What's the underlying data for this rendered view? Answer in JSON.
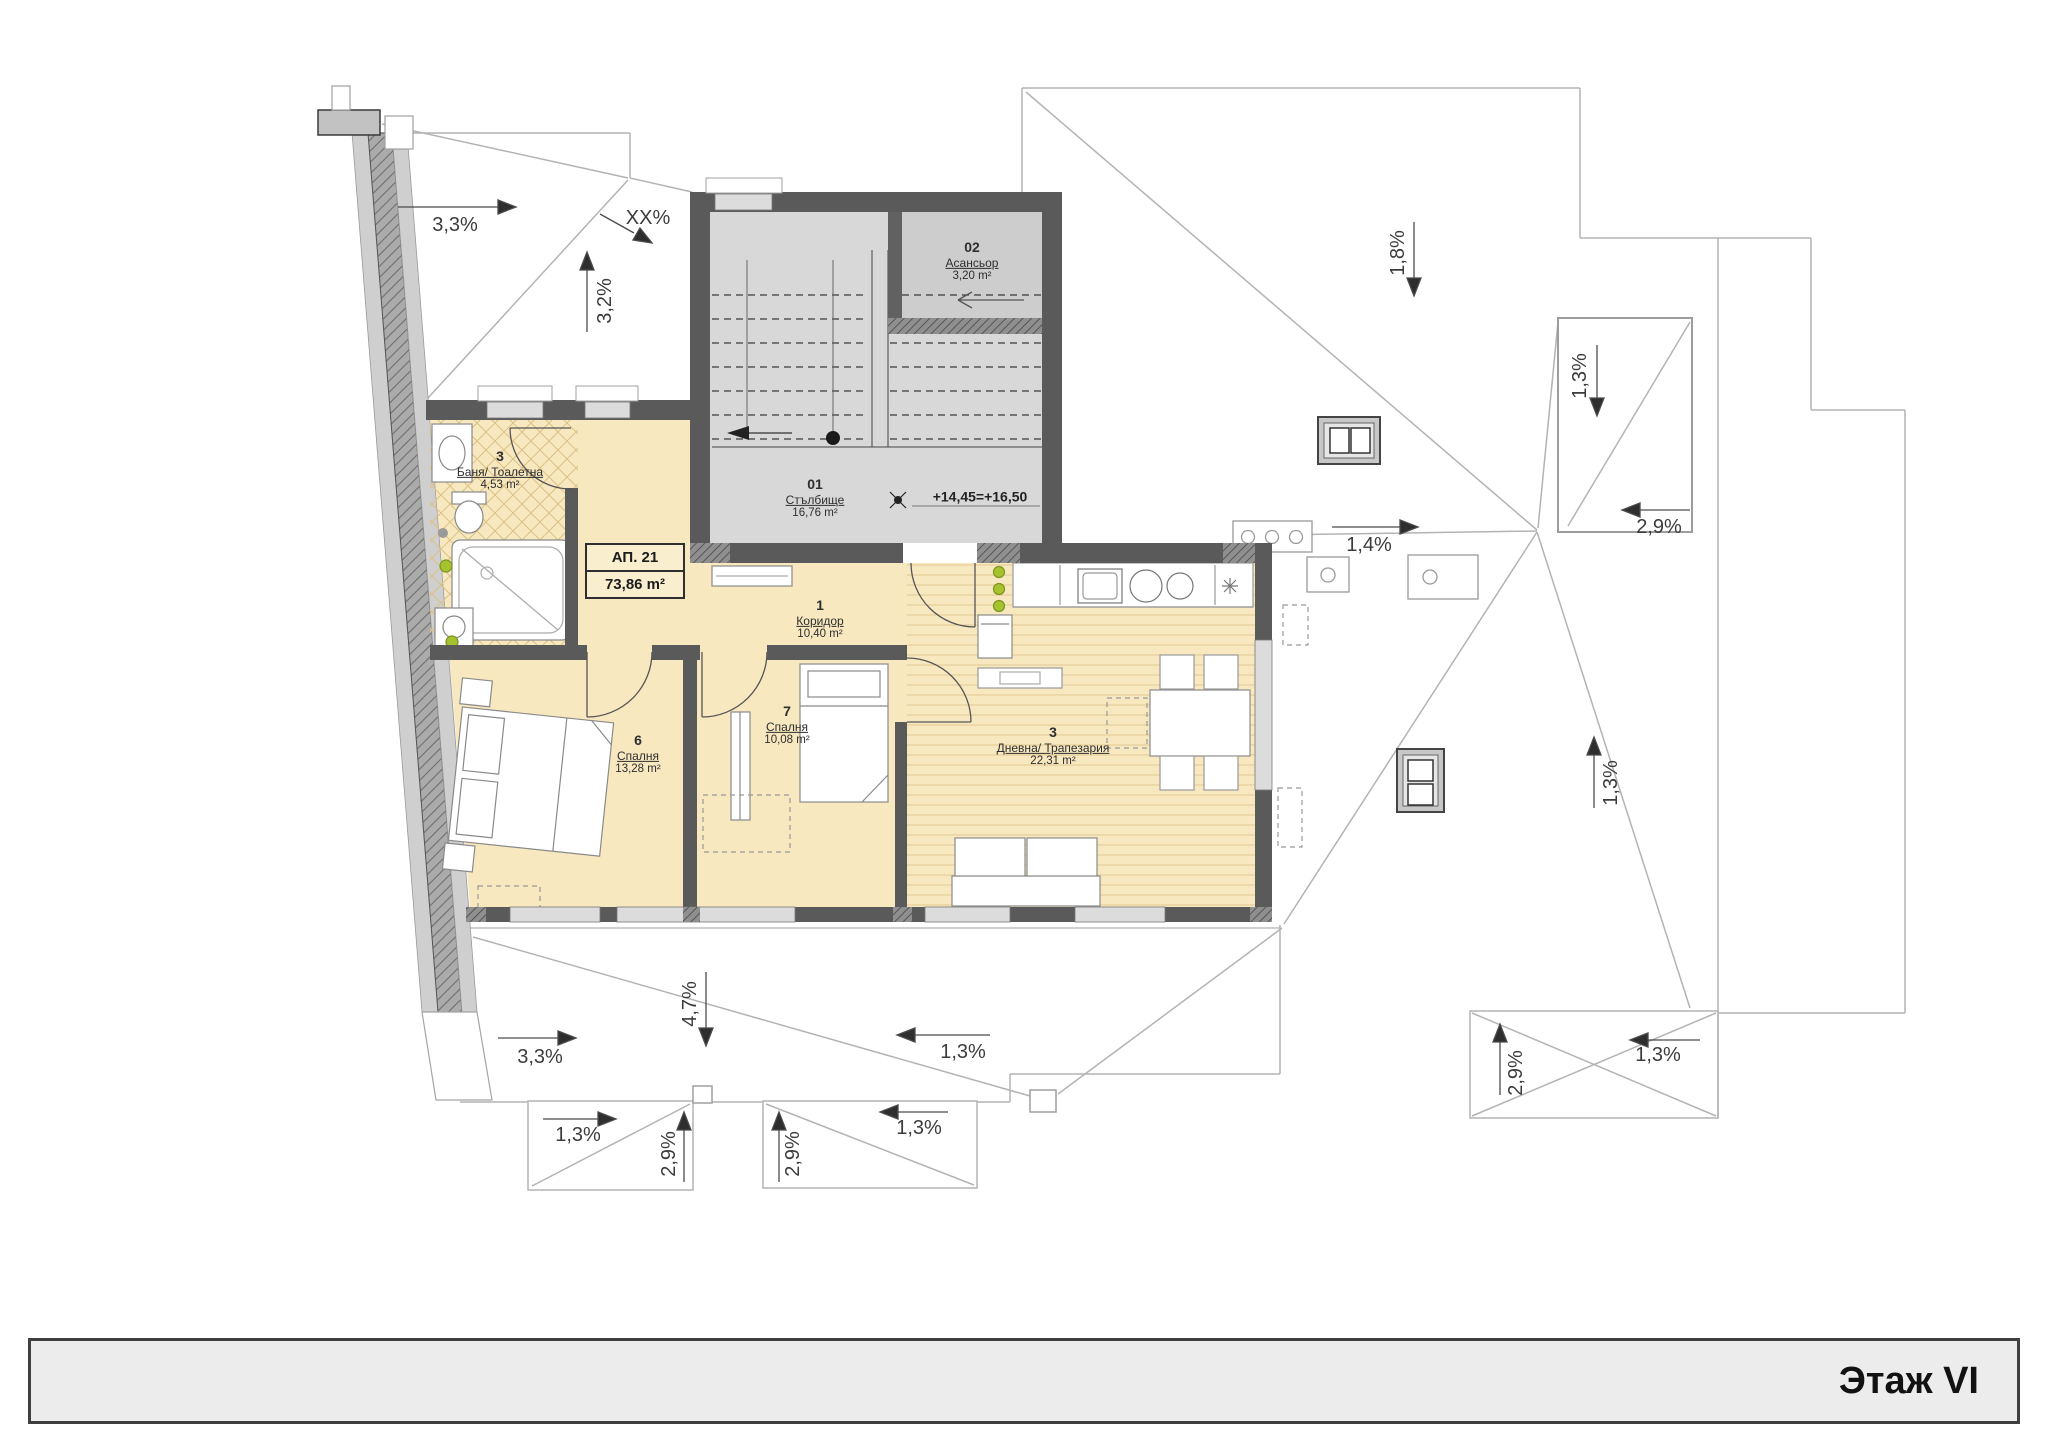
{
  "title_bar": {
    "label": "Этаж VI"
  },
  "apartment_box": {
    "id": "АП. 21",
    "area": "73,86 m²"
  },
  "rooms": {
    "bathroom": {
      "number": "3",
      "name": "Баня/ Тоалетна",
      "area": "4,53 m²"
    },
    "corridor": {
      "number": "1",
      "name": "Коридор",
      "area": "10,40 m²"
    },
    "bedroom_left": {
      "number": "6",
      "name": "Спалня",
      "area": "13,28 m²"
    },
    "bedroom_mid": {
      "number": "7",
      "name": "Спалня",
      "area": "10,08 m²"
    },
    "living_dining": {
      "number": "3",
      "name": "Дневна/ Трапезария",
      "area": "22,31 m²"
    },
    "staircase": {
      "number": "01",
      "name": "Стълбище",
      "area": "16,76 m²"
    },
    "elevator": {
      "number": "02",
      "name": "Асансьор",
      "area": "3,20 m²"
    }
  },
  "annotations": {
    "elevation": "+14,45=+16,50"
  },
  "roof_slopes": {
    "top_left": "3,3%",
    "top_left_unknown": "XX%",
    "top_left_vert": "3,2%",
    "top_right": "1,8%",
    "dormer_tr_down": "1,3%",
    "dormer_tr_left": "2,9%",
    "center_right": "1,4%",
    "right_mid": "1,3%",
    "bottom_left": "3,3%",
    "bottom_center_down": "4,7%",
    "bottom_center_upper": "1,3%",
    "dormer_b1_right": "1,3%",
    "dormer_b1_up": "2,9%",
    "dormer_b2_up": "2,9%",
    "bottom_center_lower": "1,3%",
    "dormer_br_up": "2,9%",
    "dormer_br_left": "1,3%"
  },
  "colors": {
    "room_fill": "#f7e8c0",
    "stair_fill": "#d8d8d8",
    "wall": "#5a5a5a",
    "roof_line": "#b3b3b3",
    "accent_dot": "#a6c22e",
    "title_bg": "#ececec"
  }
}
